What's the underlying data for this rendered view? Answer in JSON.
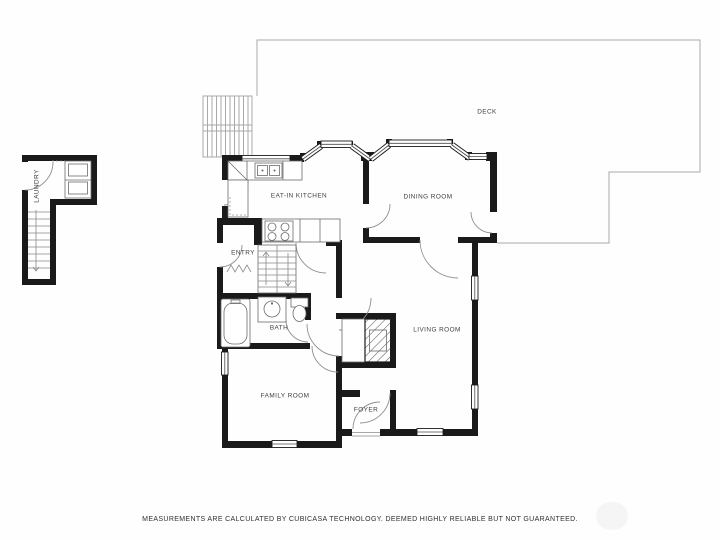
{
  "rooms": {
    "deck": {
      "label": "DECK"
    },
    "kitchen": {
      "label": "EAT-IN KITCHEN"
    },
    "dining": {
      "label": "DINING ROOM"
    },
    "entry": {
      "label": "ENTRY"
    },
    "bath": {
      "label": "BATH"
    },
    "living": {
      "label": "LIVING ROOM"
    },
    "family": {
      "label": "FAMILY ROOM"
    },
    "foyer": {
      "label": "FOYER"
    },
    "laundry": {
      "label": "LAUNDRY"
    }
  },
  "footer": {
    "disclaimer": "MEASUREMENTS ARE CALCULATED BY CUBICASA TECHNOLOGY. DEEMED HIGHLY RELIABLE BUT NOT GUARANTEED."
  },
  "theme": {
    "wall_color": "#1a1a1a",
    "thin_line_color": "#6b6b6b",
    "deck_line_color": "#a9a9a9",
    "label_color": "#3d3d3d"
  }
}
